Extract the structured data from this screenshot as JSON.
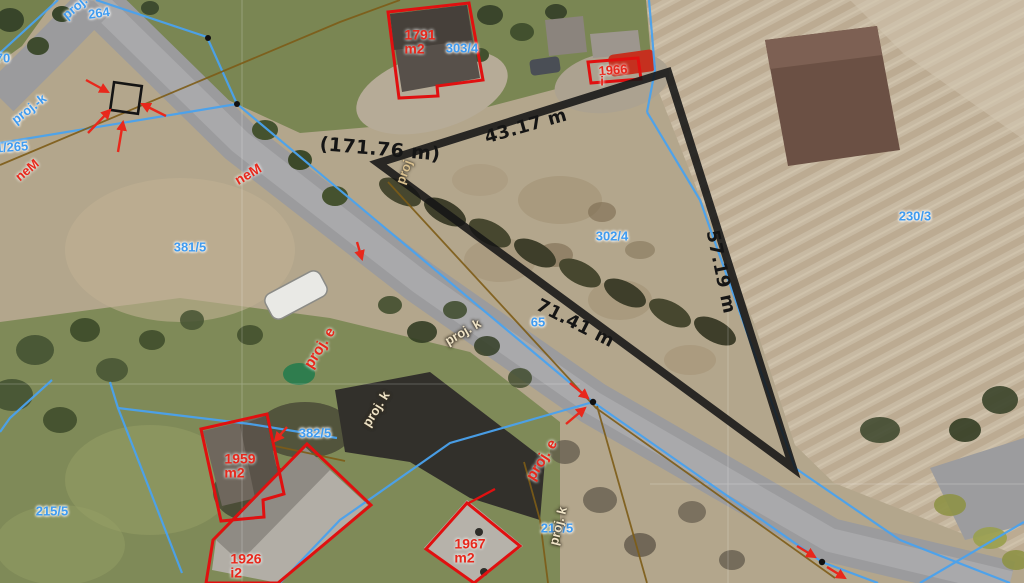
{
  "map_overlay": {
    "measurement": {
      "segment_top": "43.17 m",
      "segment_right": "57.19 m",
      "segment_bottom": "71.41 m",
      "total": "(171.76 m)"
    },
    "parcel_numbers": {
      "p264": "264",
      "p70": "70",
      "p1265": "1/265",
      "p381_5": "381/5",
      "p303_4": "303/4",
      "p302_4": "302/4",
      "p230_3": "230/3",
      "p65": "65",
      "p215_5": "215/5",
      "p382_5": "382/5",
      "p216_5": "216/5"
    },
    "building_labels": {
      "b1791": {
        "id": "1791",
        "suffix": "m2"
      },
      "b1966": {
        "id": "1966",
        "suffix": "i"
      },
      "b1959": {
        "id": "1959",
        "suffix": "m2"
      },
      "b1926": {
        "id": "1926",
        "suffix": "i2"
      },
      "b1967": {
        "id": "1967",
        "suffix": "m2"
      }
    },
    "project_labels": {
      "proj_k_top": "proj. k",
      "proj_k_left": "proj.-k",
      "proj_k_mid": "proj. k",
      "proj_k_road": "proj. k",
      "proj_k_bottom": "proj. k",
      "proj_edge": "proj",
      "proj_e_1": "proj. e",
      "proj_e_2": "proj. e",
      "nem_1": "neM",
      "nem_2": "neM"
    },
    "colors": {
      "parcel_boundary_blue": "#4aa2ee",
      "utility_brown": "#7d5c17",
      "measure_black": "#161616",
      "building_outline_red": "#e01010",
      "label_blue": "#3f9bf0",
      "label_red": "#e8281c",
      "label_light": "#efe3c6"
    }
  }
}
